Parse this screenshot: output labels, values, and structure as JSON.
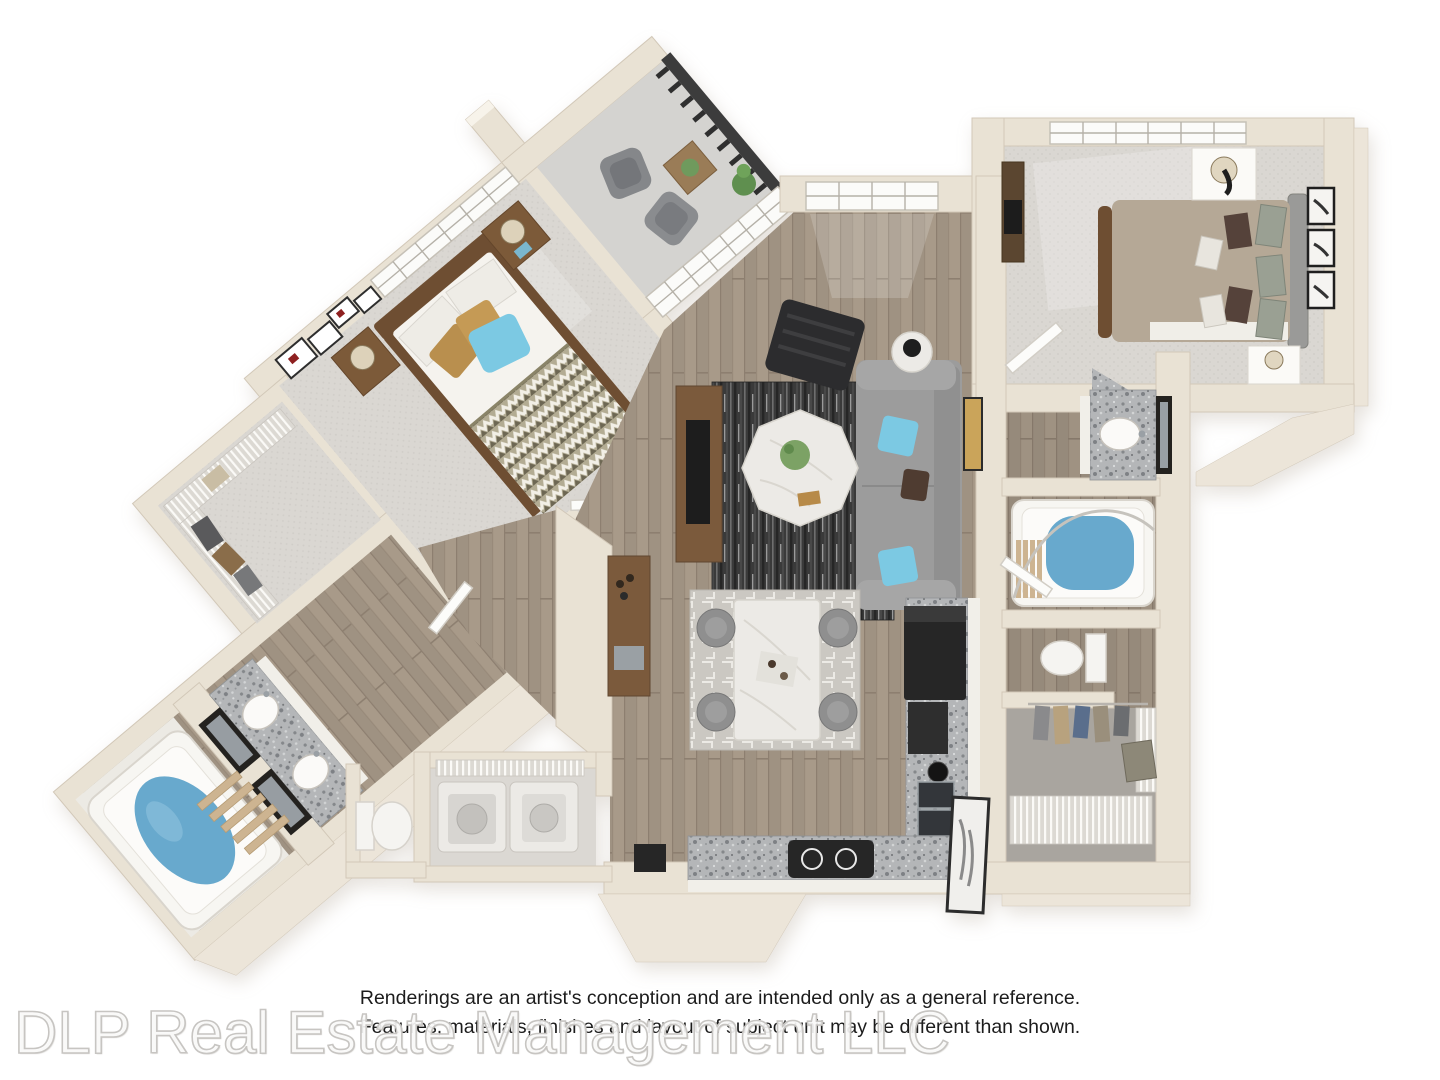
{
  "page": {
    "background": "#ffffff",
    "width": 1440,
    "height": 1080
  },
  "floorplan": {
    "kind": "3d-rendered-floor-plan",
    "rooms": [
      "balcony",
      "master-bedroom",
      "walk-in-closet",
      "master-bathroom",
      "living-room",
      "dining-area",
      "kitchen",
      "laundry-room",
      "second-bedroom",
      "second-bathroom",
      "hall-closet"
    ]
  },
  "disclaimer": {
    "line1": "Renderings are an artist's conception and are intended only as a general reference.",
    "line2": "Features, materials, finishes and layout of subject unit may be different than shown."
  },
  "watermark": {
    "text": "DLP Real Estate Management LLC"
  },
  "palette": {
    "wall": "#e9e2d4",
    "wall_edge": "#d2c8b8",
    "wall_apron": "#ece5d9",
    "carpet": "#dad7d2",
    "wood": "#a89a89",
    "balcony_floor": "#d4d3d0",
    "rug": "#3a3a3a",
    "dining_rug": "#cbc8c2",
    "sofa": "#9c9c9c",
    "pillow_blue": "#7cc9e3",
    "comforter_taupe": "#b5a896",
    "water": "#68a9cd",
    "granite": "#b4b6b8",
    "cabinet": "#f1efe9",
    "wood_furniture": "#7b5a3c",
    "marble": "#eceae6",
    "appliance": "#262626",
    "railing": "#3c3c3c"
  }
}
